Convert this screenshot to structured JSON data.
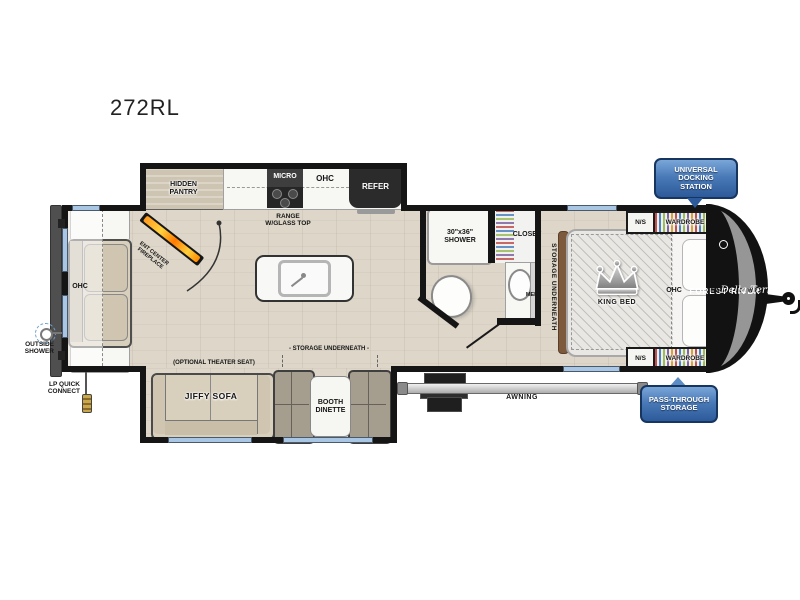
{
  "title": "272RL",
  "kitchen": {
    "hidden_pantry": "HIDDEN\nPANTRY",
    "micro": "MICRO",
    "ohc": "OHC",
    "refer": "REFER",
    "range": "RANGE\nW/GLASS TOP",
    "fireplace": "ENT CENTER\nFIREPLACE"
  },
  "bath": {
    "shower": "30\"x36\"\nSHOWER",
    "closet": "CLOSET",
    "med": "MED"
  },
  "bedroom": {
    "storage": "STORAGE UNDERNEATH",
    "king_bed": "KING BED",
    "ohc": "OHC",
    "ns_top": "N/S",
    "wardrobe_top": "WARDROBE",
    "ns_bottom": "N/S",
    "wardrobe_bottom": "WARDROBE"
  },
  "living": {
    "ohc": "OHC",
    "theater_note": "(OPTIONAL THEATER SEAT)",
    "jiffy_sofa": "JIFFY SOFA",
    "storage": "- STORAGE UNDERNEATH -",
    "booth_dinette": "BOOTH\nDINETTE"
  },
  "exterior": {
    "awning": "AWNING",
    "docking_badge": "UNIVERSAL\nDOCKING\nSTATION",
    "pass_badge": "PASS-THROUGH\nSTORAGE",
    "outside_shower": "OUTSIDE\nSHOWER",
    "lp_connect": "LP QUICK\nCONNECT"
  },
  "brand": {
    "forest_river": "FOREST RIVER",
    "east_west": "EAST TO WEST",
    "model_line": "Della Terra"
  },
  "colors": {
    "badge_blue": "#3f6fae",
    "wall_black": "#151515",
    "floor_wood": "#ddd6c9",
    "window_blue": "#a9c7e5",
    "front_cap_gray": "#969696"
  }
}
